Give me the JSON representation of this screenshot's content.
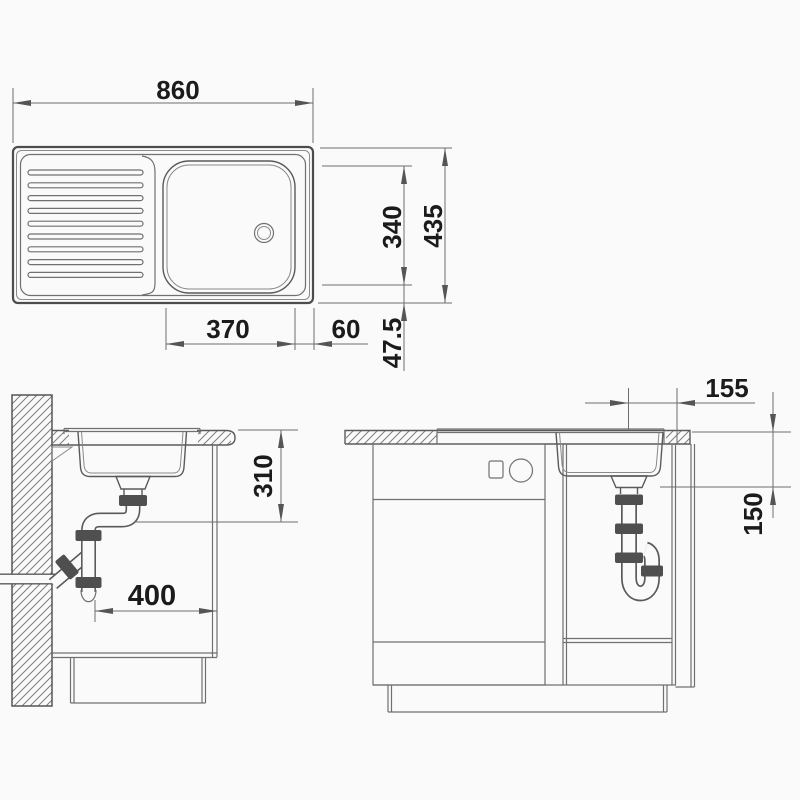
{
  "drawing": {
    "subject": "kitchen sink technical dimension drawing",
    "views": {
      "plan": "sink top view with drainer and bowl",
      "side": "side section at wall with waste trap",
      "front": "front section of base cabinet with waste trap"
    }
  },
  "dims": {
    "plan": {
      "width": "860",
      "depth": "435",
      "bowl_depth": "340",
      "bowl_width": "370",
      "bowl_right_margin": "60",
      "bowl_bottom_margin": "47.5"
    },
    "side": {
      "outlet_height": "310",
      "outlet_wall_distance": "400"
    },
    "front": {
      "outlet_offset_right": "155",
      "outlet_drop": "150"
    }
  },
  "colors": {
    "background": "#fafafa",
    "line_primary": "#4d4d4d",
    "line_secondary": "#707070",
    "hatch": "#7d7d7d",
    "dimension_text": "#1b1b1b"
  }
}
